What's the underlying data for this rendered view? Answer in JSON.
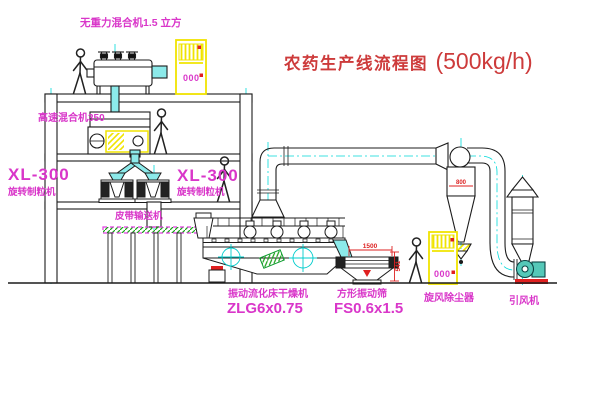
{
  "title": {
    "name": "农药生产线流程图",
    "capacity": "(500kg/h)"
  },
  "equipment": {
    "gravity_mixer": {
      "label": "无重力混合机1.5 立方"
    },
    "high_speed_mixer": {
      "label": "高速混合机350"
    },
    "granulator_left": {
      "model": "XL-300",
      "name": "旋转制粒机"
    },
    "granulator_right": {
      "model": "XL-300",
      "name": "旋转制粒机"
    },
    "belt_conveyor": {
      "label": "皮带输送机"
    },
    "fluid_bed_dryer": {
      "name": "振动流化床干燥机",
      "model": "ZLG6x0.75"
    },
    "vibrating_screen": {
      "name": "方形振动筛",
      "model": "FS0.6x1.5"
    },
    "cyclone": {
      "name": "旋风除尘器"
    },
    "induced_draft_fan": {
      "name": "引风机"
    }
  },
  "dimensions": {
    "screen_length": "1500",
    "screen_height": "541",
    "cyclone_dia": "800"
  },
  "control_cabinets": {
    "cabinet1_display": "000",
    "cabinet2_display": "000"
  },
  "colors": {
    "line": "#1c1c1c",
    "centerline": "#00d9d9",
    "label_magenta": "#d936c9",
    "title_red": "#cd3b3b",
    "accent_yellow": "#f0e400",
    "dim_red": "#dd2222",
    "pipe_cyan": "#8ceaea",
    "belt_green": "#18a018",
    "fan_teal": "#55c8b8"
  }
}
